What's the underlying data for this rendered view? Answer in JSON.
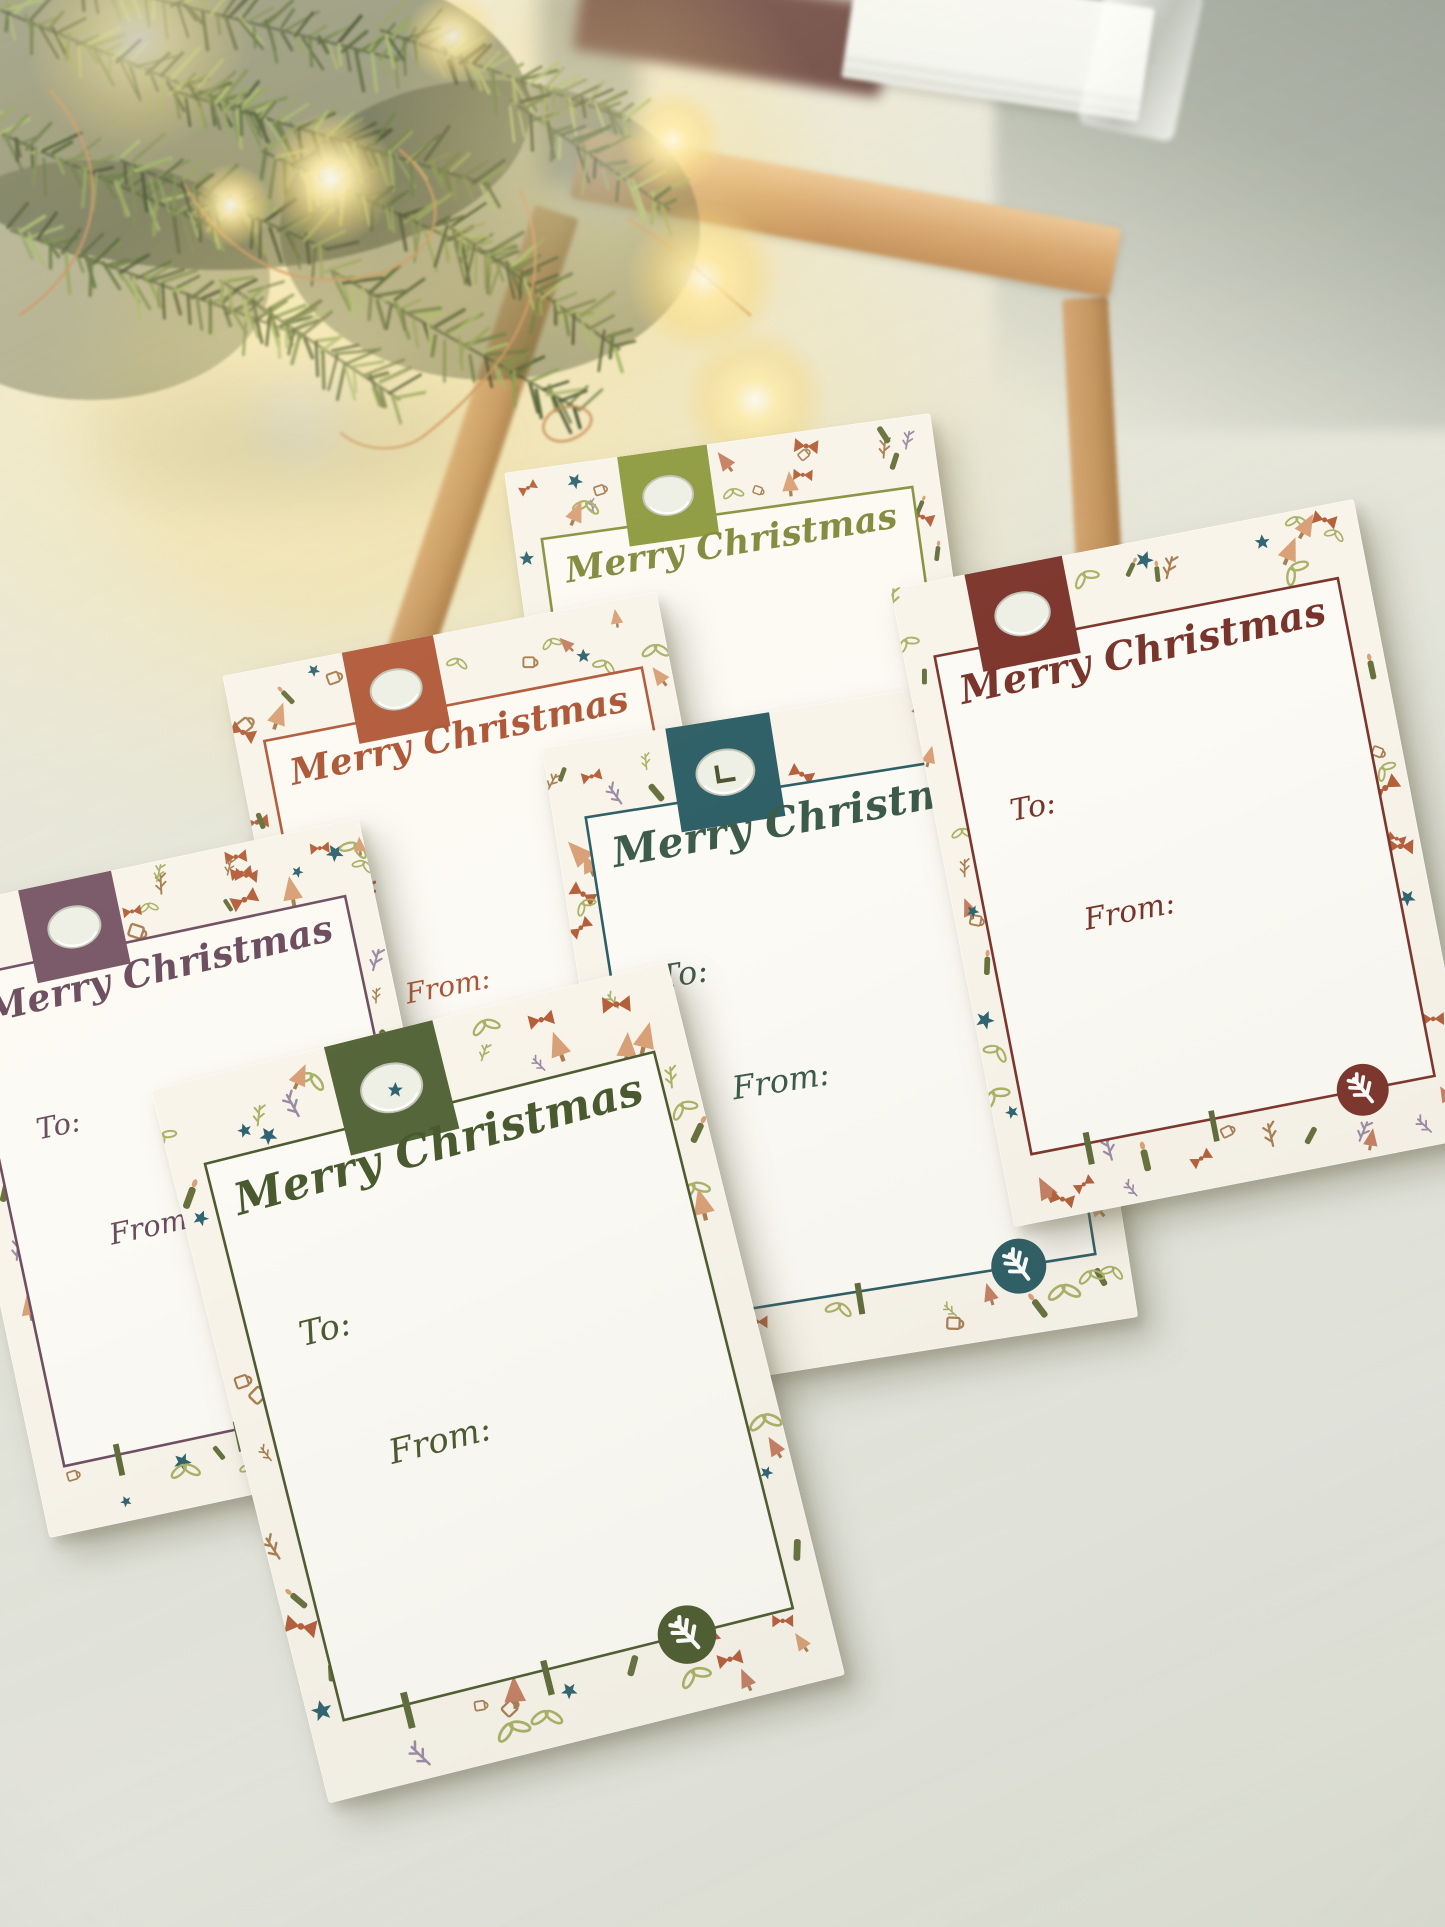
{
  "scene": {
    "surface_color": "#e3e4da",
    "wall_color": "#a3a89e",
    "glow_color": "#f7d77a",
    "wood_color": "#d7a269",
    "cards_color": "#f4f6f1",
    "card_back_color": "#5d3230",
    "wire_color": "#c68a56",
    "branch_colors": [
      "#2c3a1b",
      "#3e4f24",
      "#52662f",
      "#6a7f3d",
      "#82974c",
      "#9bb062"
    ],
    "paper_color": "#f8f4ea",
    "inner_paper_color": "#fcfaf4"
  },
  "pattern": {
    "candle": "#66713d",
    "flame": "#d9a077",
    "tree": "#d9a077",
    "tree_alt": "#c57f63",
    "bow": "#b55f3b",
    "star": "#2f6470",
    "leaf": "#a9b266",
    "sprig_purple": "#9b8aa4",
    "sprig_brown": "#a87e52",
    "trunk": "#5f6c3a",
    "mug": "#a87e52"
  },
  "tags": [
    {
      "id": "olive-tag",
      "title": "Merry Christmas",
      "to_label": "To:",
      "from_label": "From:",
      "accent": "#879240",
      "tab": "#8d9a3e",
      "text": "#7f8a3c",
      "hole_reveal": "none"
    },
    {
      "id": "rust-tag",
      "title": "Merry Christmas",
      "to_label": "To:",
      "from_label": "From:",
      "accent": "#b0593a",
      "tab": "#b0593a",
      "text": "#ab5535",
      "hole_reveal": "none"
    },
    {
      "id": "teal-tag",
      "title": "Merry Christmas",
      "to_label": "To:",
      "from_label": "From:",
      "accent": "#2d5e66",
      "tab": "#2d5e66",
      "text": "#3c5a49",
      "hole_reveal": "mark"
    },
    {
      "id": "maroon-tag",
      "title": "Merry Christmas",
      "to_label": "To:",
      "from_label": "From:",
      "accent": "#7c352c",
      "tab": "#7c352c",
      "text": "#78342b",
      "hole_reveal": "none"
    },
    {
      "id": "plum-tag",
      "title": "Merry Christmas",
      "to_label": "To:",
      "from_label": "From:",
      "accent": "#6f4f63",
      "tab": "#775666",
      "text": "#6b4c5e",
      "hole_reveal": "none"
    },
    {
      "id": "green-tag",
      "title": "Merry Christmas",
      "to_label": "To:",
      "from_label": "From:",
      "accent": "#4e5c31",
      "tab": "#55663a",
      "text": "#4a5a2f",
      "hole_reveal": "star"
    }
  ]
}
